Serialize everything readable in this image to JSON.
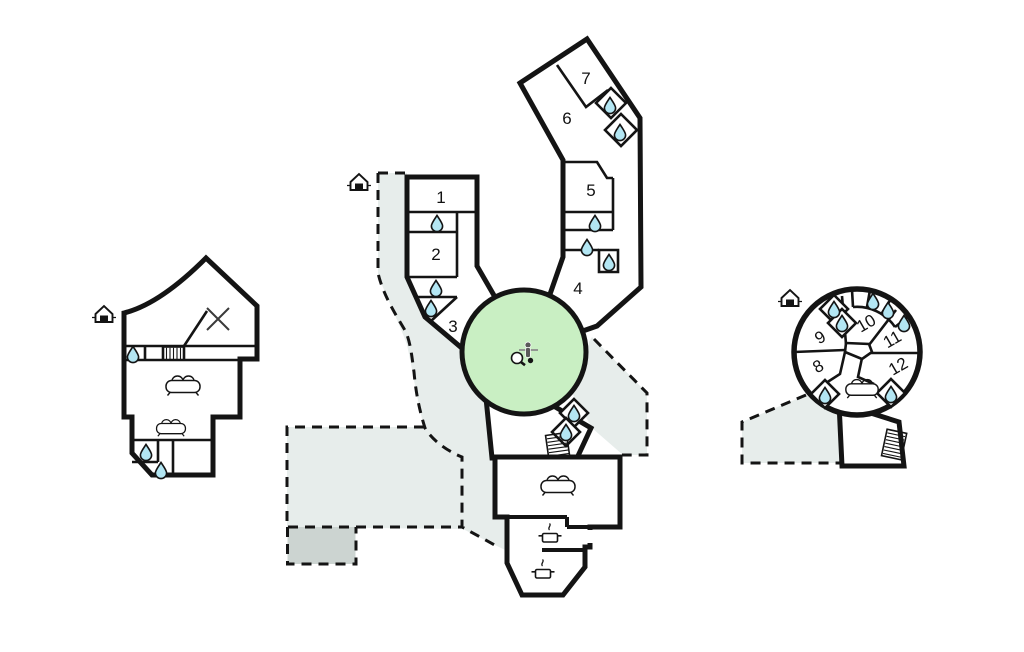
{
  "title": "Holiday house floor plan",
  "colors": {
    "wall": "#141414",
    "terrace_fill": "#e7edeb",
    "terrace_dark_fill": "#ccd4d1",
    "lawn_green": "#c9efc3",
    "water_blue": "#b3e6f3",
    "background": "#ffffff"
  },
  "rooms": [
    {
      "label": "1",
      "wing": "central-left-wing"
    },
    {
      "label": "2",
      "wing": "central-left-wing"
    },
    {
      "label": "3",
      "wing": "central-left-wing"
    },
    {
      "label": "4",
      "wing": "central-right-wing"
    },
    {
      "label": "5",
      "wing": "central-right-wing"
    },
    {
      "label": "6",
      "wing": "central-top-wing"
    },
    {
      "label": "7",
      "wing": "central-top-wing"
    },
    {
      "label": "8",
      "wing": "east-round-building"
    },
    {
      "label": "9",
      "wing": "east-round-building"
    },
    {
      "label": "10",
      "wing": "east-round-building"
    },
    {
      "label": "11",
      "wing": "east-round-building"
    },
    {
      "label": "12",
      "wing": "east-round-building"
    }
  ],
  "icons": {
    "water_drop_count": 19,
    "sofa_count": 4,
    "cooking_pot_count": 2,
    "entrance_count": 3,
    "stairs_count": 3,
    "names": [
      "water-drop-icon",
      "sofa-icon",
      "cooking-pot-icon",
      "entrance-house-icon",
      "stairs-icon",
      "cross-icon",
      "game-table-icon"
    ]
  },
  "areas": {
    "lawn": "central round green court",
    "terraces": "dashed grey outdoor areas"
  }
}
